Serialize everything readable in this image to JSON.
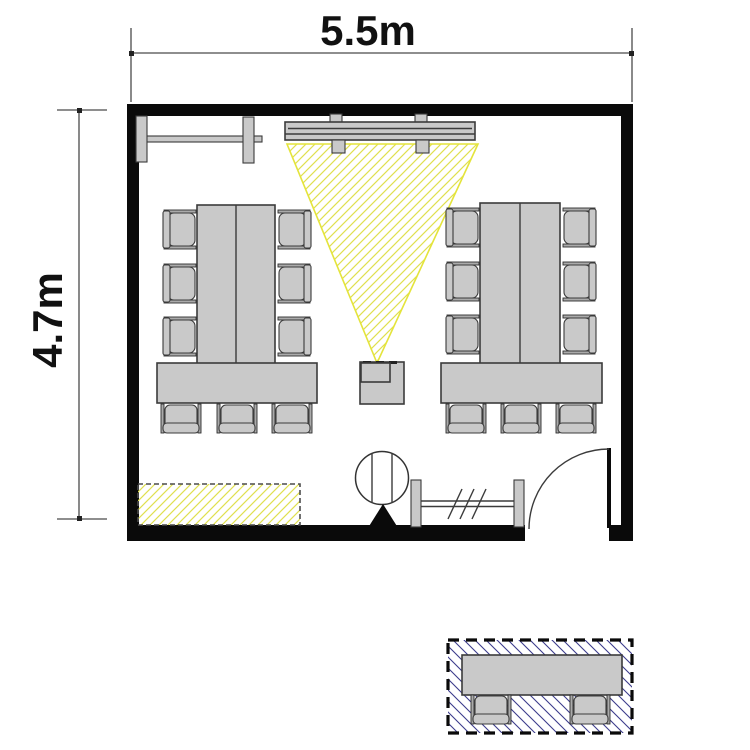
{
  "dimensions": {
    "width_label": "5.5m",
    "height_label": "4.7m"
  },
  "colors": {
    "wall": "#0a0a0a",
    "furniture_fill": "#c9c9c9",
    "furniture_stroke": "#3b3b3b",
    "projection_hatch": "#e4e43c",
    "external_hatch": "#3c3c8c",
    "dimension_line": "#4a4a4a",
    "background": "#ffffff"
  },
  "room": {
    "conference_table_groups": 2,
    "chairs_per_group": 9,
    "external_table_chairs": 2,
    "elements": [
      "wall-mounted-whiteboard",
      "projection-screen",
      "projection-beam",
      "projector",
      "conference-table-left",
      "conference-table-right",
      "sideboard-hatched",
      "column-with-pointer",
      "glass-partition",
      "entry-door-with-swing",
      "external-table-area"
    ]
  }
}
